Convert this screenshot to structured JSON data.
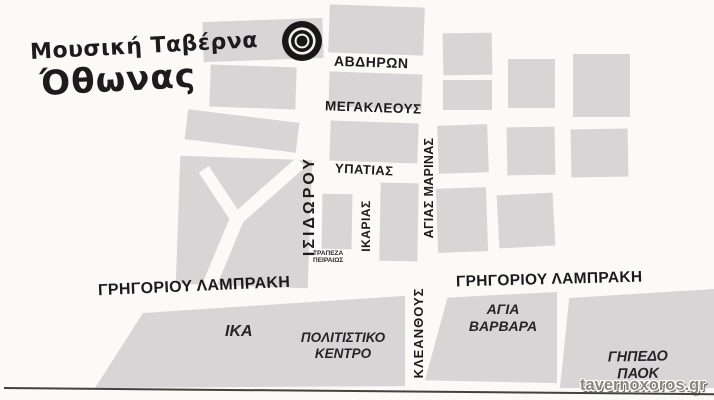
{
  "card": {
    "title_line1": "Μουσική Ταβέρνα",
    "title_line2": "Όθωνας",
    "watermark": "tavernoxoros.gr"
  },
  "streets": {
    "avdiron": "ΑΒΔΗΡΩΝ",
    "megakleous": "ΜΕΓΑΚΛΕΟΥΣ",
    "ypatias": "ΥΠΑΤΙΑΣ",
    "isidorou": "ΙΣΙΔΩΡΟΥ",
    "ikarias": "ΙΚΑΡΙΑΣ",
    "agias_marinas": "ΑΓΙΑΣ ΜΑΡΙΝΑΣ",
    "kleanthous": "ΚΛΕΑΝΘΟΥΣ",
    "grigoriou_lampraki": "ΓΡΗΓΟΡΙΟΥ ΛΑΜΠΡΑΚΗ"
  },
  "places": {
    "bank_line1": "ΤΡΑΠΕΖΑ",
    "bank_line2": "ΠΕΙΡΑΙΩΣ",
    "ika": "ΙΚΑ",
    "cultural_center_line1": "ΠΟΛΙΤΙΣΤΙΚΟ",
    "cultural_center_line2": "ΚΕΝΤΡΟ",
    "agia_varvara_line1": "ΑΓΙΑ",
    "agia_varvara_line2": "ΒΑΡΒΑΡΑ",
    "paok_stadium_line1": "ΓΗΠΕΔΟ",
    "paok_stadium_line2": "ΠΑΟΚ"
  },
  "marker_icon": "bullseye-target",
  "colors": {
    "background": "#fbfaf7",
    "block": "#d7d5d6",
    "ink": "#1b1a1c",
    "marker": "#171717",
    "border_line": "#45413c",
    "watermark_fill": "#8b847c"
  }
}
